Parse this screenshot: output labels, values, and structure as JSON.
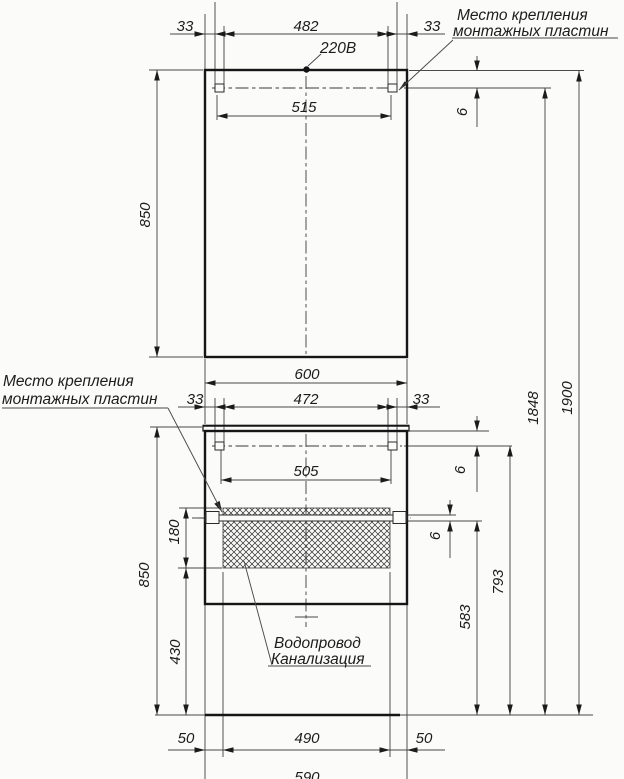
{
  "notes": {
    "power": "220В",
    "mounting_top_1": "Место крепления",
    "mounting_top_2": "монтажных пластин",
    "mounting_left_1": "Место крепления",
    "mounting_left_2": "монтажных пластин",
    "plumbing_1": "Водопровод",
    "plumbing_2": "Канализация"
  },
  "dims": {
    "mirror_plate_inset_left": "33",
    "mirror_plate_span_inner": "482",
    "mirror_plate_inset_right": "33",
    "mirror_plate_span_center": "515",
    "mirror_plate_drop": "6",
    "mirror_height": "850",
    "cabinet_width": "600",
    "cabinet_plate_inset_left": "33",
    "cabinet_plate_span_inner": "472",
    "cabinet_plate_inset_right": "33",
    "cabinet_plate_span_center": "505",
    "cabinet_plate_drop": "6",
    "rail_thickness": "6",
    "hatch_height": "180",
    "cabinet_height": "850",
    "hatch_bottom_to_floor": "430",
    "rail_to_floor": "583",
    "plate_to_floor": "793",
    "mirror_plate_to_floor": "1848",
    "mirror_top_to_floor": "1900",
    "base_offset_left": "50",
    "base_span": "490",
    "base_offset_right": "50",
    "base_total": "590"
  }
}
